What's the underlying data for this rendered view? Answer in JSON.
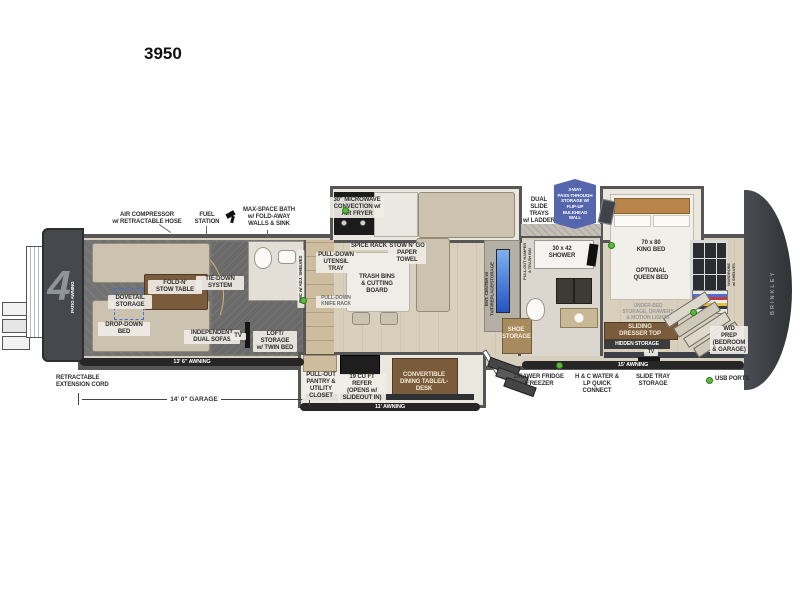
{
  "model": "3950",
  "legend": {
    "usb_ports": "USB PORTS"
  },
  "colors": {
    "badge_blue": "#5566ad",
    "fireplace_blue": "#3f7fe0",
    "usb_green": "#58bb3c",
    "wall_gray": "#565656",
    "wood_floor": "#d8cfbd",
    "garage_floor": "#737373",
    "accent_tan": "#b9854a",
    "front_cap_dark": "#35383d"
  },
  "exterior": {
    "patio_awning": "PATIO AWNING",
    "ramp_numeral": "4",
    "brand": "BRINKLEY",
    "awning_garage": "13' 6\" AWNING",
    "awning_door_side": "11' AWNING",
    "awning_bedroom": "15' AWNING",
    "garage_dimension": "14' 0\" GARAGE",
    "retractable_cord": "RETRACTABLE\nEXTENSION CORD"
  },
  "callouts": {
    "air_compressor": "AIR COMPRESSOR\nw/ RETRACTABLE HOSE",
    "fuel_station": "FUEL\nSTATION",
    "max_space_bath": "MAX-SPACE BATH\nw/ FOLD-AWAY\nWALLS & SINK",
    "microwave": "30\" MICROWAVE\nCONVECTION w/\nAIR FRYER",
    "dual_slide_trays": "DUAL\nSLIDE TRAYS\nw/ LADDER",
    "pass_through": "3-WAY\nPASS-THROUGH\nSTORAGE W/\nFLIP-UP\nBULKHEAD\nWALL"
  },
  "garage": {
    "fold_n_stow": "FOLD-N'\nSTOW TABLE",
    "dovetail": "DOVETAIL\nSTORAGE",
    "drop_down_bed": "DROP-DOWN\nBED",
    "tie_down": "TIE-DOWN\nSYSTEM",
    "dual_sofas": "INDEPENDENT\nDUAL SOFAS",
    "tv": "TV",
    "loft": "LOFT/\nSTORAGE\nw/ TWIN BED"
  },
  "kitchen": {
    "ohc": "OHC w/ ADJ. SHELVES",
    "spice_rack": "SPICE RACK",
    "stow_n_go": "STOW N' GO\nPAPER\nTOWEL",
    "utensil_tray": "PULL-DOWN\nUTENSIL\nTRAY",
    "trash_bins": "TRASH BINS\n& CUTTING BOARD",
    "knife_rack": "PULL-DOWN\nKNIFE RACK",
    "pantry": "PULL-OUT\nPANTRY &\nUTILITY\nCLOSET",
    "refer": "19 CU FT REFER\n(OPENS w/\nSLIDEOUT IN)",
    "dining_table": "CONVERTIBLE\nDINING TABLE/L-DESK",
    "ent_center": "ENT. CENTER w/\nTV/FIREPLACE/STORAGE",
    "shoe_storage": "SHOE\nSTORAGE"
  },
  "bath": {
    "hamper": "PULL-OUT HAMPER\n& TRASH BIN",
    "shower": "30 x 42\nSHOWER"
  },
  "bedroom": {
    "king_bed": "70 x 80\nKING BED",
    "optional_queen": "OPTIONAL\nQUEEN BED",
    "under_bed": "UNDER-BED\nSTORAGE, DRAWERS\n& MOTION LIGHTS",
    "sliding_dresser": "SLIDING\nDRESSER TOP",
    "hidden_storage": "HIDDEN STORAGE",
    "wd_prep": "W/D\nPREP\n(BEDROOM\n& GARAGE)",
    "wardrobe": "WARDROBE\nw/ SHELVES",
    "tv": "TV"
  },
  "underbody": {
    "drawer_fridge": "DRAWER FRIDGE\n/FREEZER",
    "hc_water": "H & C WATER &\nLP QUICK CONNECT",
    "slide_tray": "SLIDE TRAY\nSTORAGE"
  }
}
